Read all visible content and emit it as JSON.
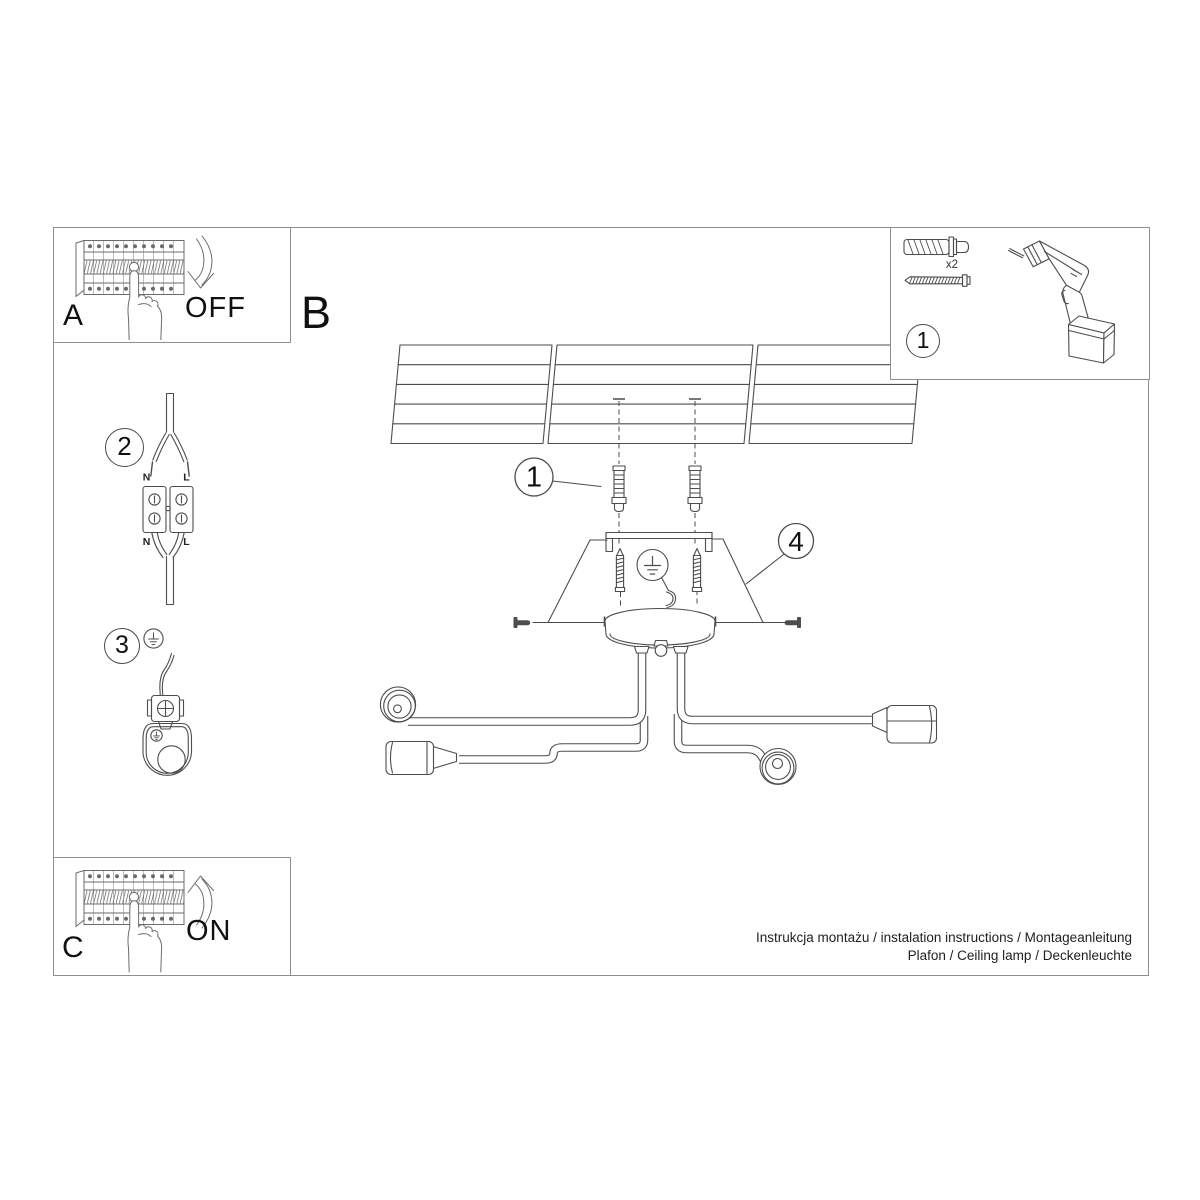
{
  "labels": {
    "section_a": "A",
    "section_b": "B",
    "section_c": "C",
    "power_off": "OFF",
    "power_on": "ON"
  },
  "steps": {
    "step1": "1",
    "step2": "2",
    "step3": "3",
    "step4": "4",
    "tools_step": "1"
  },
  "tools": {
    "dowel_qty": "x2"
  },
  "wiring": {
    "n_top": "N",
    "l_top": "L",
    "n_bottom": "N",
    "l_bottom": "L"
  },
  "footer": {
    "line1": "Instrukcja montażu / instalation instructions / Montageanleitung",
    "line2": "Plafon / Ceiling lamp / Deckenleuchte"
  },
  "colors": {
    "line": "#4d4d4d",
    "frame": "#8f8f8f",
    "text": "#111111"
  }
}
